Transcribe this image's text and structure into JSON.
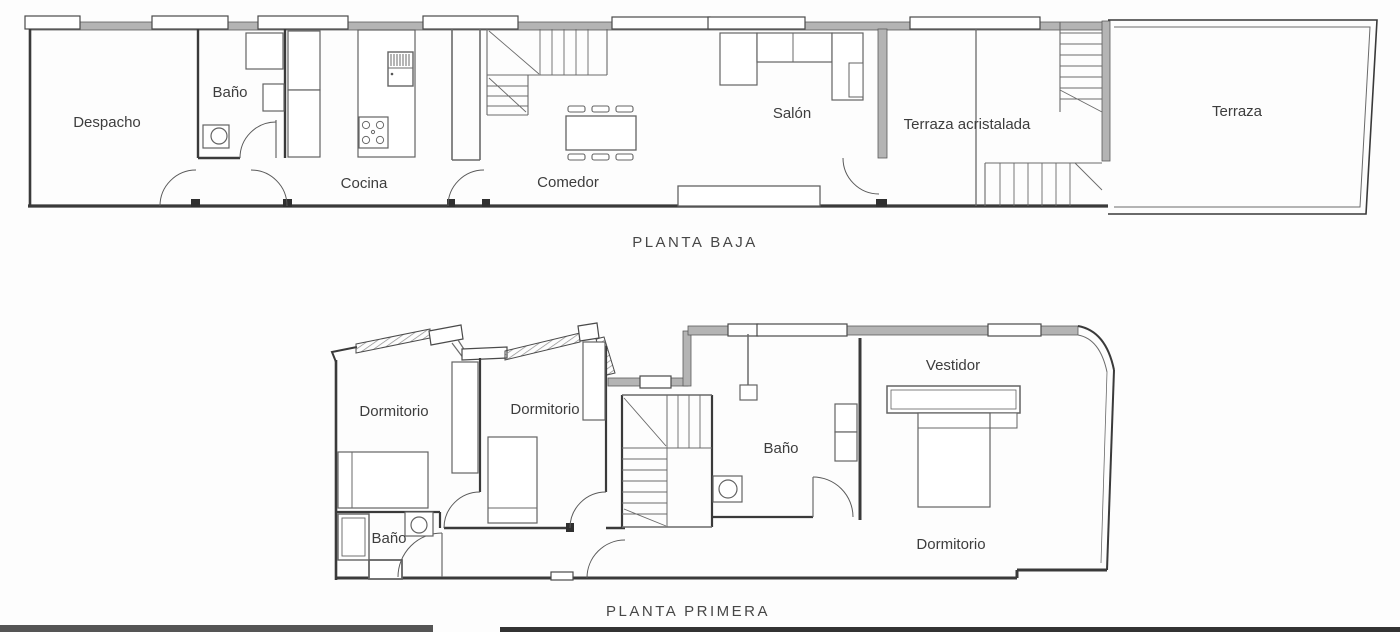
{
  "document": {
    "kind": "architectural floor plan, two storeys, black line drawing on white"
  },
  "plans": {
    "planta_baja": {
      "title": "PLANTA BAJA",
      "rooms": {
        "despacho": "Despacho",
        "bano": "Baño",
        "cocina": "Cocina",
        "comedor": "Comedor",
        "salon": "Salón",
        "terraza_acristalada": "Terraza acristalada",
        "terraza": "Terraza"
      }
    },
    "planta_primera": {
      "title": "PLANTA PRIMERA",
      "rooms": {
        "dormitorio_izq": "Dormitorio",
        "dormitorio_centro": "Dormitorio",
        "bano_pequeno": "Baño",
        "bano_principal": "Baño",
        "vestidor": "Vestidor",
        "dormitorio_principal": "Dormitorio"
      }
    }
  },
  "colors": {
    "line": "#3a3a3a",
    "wall_fill": "#b4b4b4",
    "label_text": "#3d3d3d",
    "bottom_bar_left": "#555555",
    "bottom_bar_right": "#333333",
    "background": "#fdfdfd"
  }
}
